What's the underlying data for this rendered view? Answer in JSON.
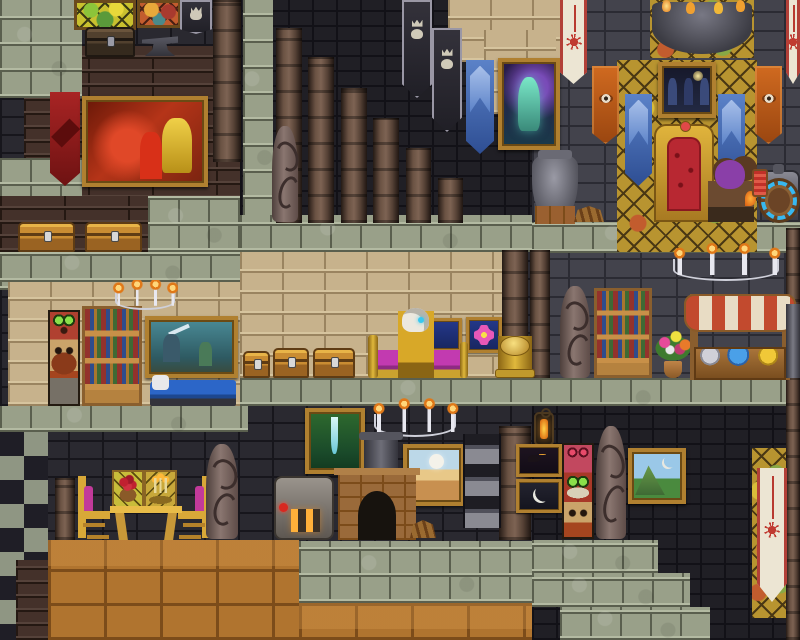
{
  "meta": {
    "scene_name": "castle-interior-game-scene",
    "scene_type": "2d-sandbox-side-view",
    "visible_text": []
  },
  "palette": {
    "stone_slab": "#99a089",
    "dark_brick": "#2a2930",
    "black_brick": "#201f25",
    "gray_brick": "#43434c",
    "sandstone_brick": "#c7b28c",
    "mud_brick": "#b0742f",
    "wood_plank": "#44312a",
    "gold_accent": "#c9982f",
    "stained_glass_gold": "#b89430",
    "banner_red": "#a82424",
    "banner_blue": "#4a6fb5",
    "banner_black": "#34323b",
    "banner_white": "#ece5d3",
    "banner_orange": "#d06a20",
    "throne_red": "#b82832",
    "bed_blue": "#2c66c8",
    "bed_purple_sheet": "#c23ab0",
    "awning_red": "#c24a2e",
    "flame_orange": "#f0a030",
    "gem_blue": "#4aa0e8"
  },
  "regions": [
    {
      "name": "wall-dark-brick-base",
      "tex": "darkbrick",
      "x": 0,
      "y": 0,
      "w": 800,
      "h": 640
    },
    {
      "name": "wall-black-brick-stairwell",
      "tex": "blackbrick",
      "x": 240,
      "y": 0,
      "w": 292,
      "h": 252
    },
    {
      "name": "wall-gray-brick-right",
      "tex": "graybrick",
      "x": 532,
      "y": 0,
      "w": 268,
      "h": 640
    },
    {
      "name": "wall-black-brick-bottom-right",
      "tex": "blackbrick",
      "x": 532,
      "y": 406,
      "w": 268,
      "h": 234
    },
    {
      "name": "wall-sandstone-top",
      "tex": "sandbrick",
      "x": 448,
      "y": 0,
      "w": 112,
      "h": 62
    },
    {
      "name": "wall-sandstone-top-2",
      "tex": "sandbrick",
      "x": 484,
      "y": 30,
      "w": 72,
      "h": 84
    },
    {
      "name": "wall-planks-top-left",
      "tex": "planks",
      "x": 24,
      "y": 46,
      "w": 216,
      "h": 167
    },
    {
      "name": "wall-slab-left-upper",
      "tex": "slab",
      "x": 0,
      "y": 0,
      "w": 82,
      "h": 98
    },
    {
      "name": "wall-slab-left-lower",
      "tex": "slab",
      "x": 0,
      "y": 158,
      "w": 82,
      "h": 132
    },
    {
      "name": "pillar-slab",
      "tex": "slab",
      "x": 243,
      "y": 0,
      "w": 30,
      "h": 225
    },
    {
      "name": "wall-planks-chest-ledge",
      "tex": "planks",
      "x": 0,
      "y": 196,
      "w": 148,
      "h": 56
    },
    {
      "name": "wall-slab-mid-left",
      "tex": "slab",
      "x": 148,
      "y": 196,
      "w": 92,
      "h": 56
    },
    {
      "name": "floor-slab-left-band",
      "tex": "slab",
      "x": 0,
      "y": 252,
      "w": 240,
      "h": 30
    },
    {
      "name": "wall-sandstone-left-room",
      "tex": "sandbrick",
      "x": 8,
      "y": 282,
      "w": 236,
      "h": 124
    },
    {
      "name": "ceiling-slab-center",
      "tex": "slab",
      "x": 240,
      "y": 215,
      "w": 292,
      "h": 37
    },
    {
      "name": "wall-sandstone-center-room",
      "tex": "sandbrick",
      "x": 240,
      "y": 252,
      "w": 264,
      "h": 126
    },
    {
      "name": "ceiling-slab-right",
      "tex": "slab",
      "x": 532,
      "y": 222,
      "w": 268,
      "h": 31
    },
    {
      "name": "floor-slab-left-room",
      "tex": "slab",
      "x": 0,
      "y": 406,
      "w": 248,
      "h": 26
    },
    {
      "name": "wall-checker-left",
      "tex": "checker",
      "x": 0,
      "y": 432,
      "w": 48,
      "h": 208
    },
    {
      "name": "floor-slab-main",
      "tex": "slab",
      "x": 240,
      "y": 378,
      "w": 560,
      "h": 28
    },
    {
      "name": "floor-mudbrick-left",
      "tex": "mudbrick",
      "x": 48,
      "y": 540,
      "w": 251,
      "h": 100
    },
    {
      "name": "floor-slab-bottom-center",
      "tex": "slab",
      "x": 299,
      "y": 541,
      "w": 233,
      "h": 62
    },
    {
      "name": "floor-mudbrick-center",
      "tex": "mudbrick",
      "x": 299,
      "y": 603,
      "w": 233,
      "h": 37
    },
    {
      "name": "stair-slab-1",
      "tex": "slab",
      "x": 532,
      "y": 540,
      "w": 126,
      "h": 33
    },
    {
      "name": "stair-slab-2",
      "tex": "slab",
      "x": 532,
      "y": 573,
      "w": 158,
      "h": 34
    },
    {
      "name": "stair-slab-3",
      "tex": "slab",
      "x": 560,
      "y": 607,
      "w": 150,
      "h": 33
    },
    {
      "name": "wall-planks-bottom-left",
      "tex": "planks",
      "x": 16,
      "y": 560,
      "w": 32,
      "h": 80
    },
    {
      "name": "window-stained-glass-throne-top",
      "tex": "glassgold",
      "x": 650,
      "y": 0,
      "w": 104,
      "h": 58
    },
    {
      "name": "window-stained-glass-throne",
      "tex": "glassgold",
      "x": 617,
      "y": 60,
      "w": 140,
      "h": 192
    },
    {
      "name": "window-stained-glass-bottom-right",
      "tex": "glassgold",
      "x": 752,
      "y": 448,
      "w": 40,
      "h": 170
    }
  ],
  "columns": [
    {
      "name": "wood-column",
      "x": 213,
      "y": 0,
      "w": 28,
      "h": 162
    },
    {
      "name": "wood-column-stair-1",
      "x": 276,
      "y": 28,
      "w": 26,
      "h": 195
    },
    {
      "name": "wood-column-stair-2",
      "x": 308,
      "y": 57,
      "w": 26,
      "h": 166
    },
    {
      "name": "wood-column-stair-3",
      "x": 341,
      "y": 88,
      "w": 26,
      "h": 135
    },
    {
      "name": "wood-column-stair-4",
      "x": 373,
      "y": 118,
      "w": 26,
      "h": 105
    },
    {
      "name": "wood-column-stair-5",
      "x": 406,
      "y": 148,
      "w": 25,
      "h": 75
    },
    {
      "name": "wood-column-stair-6",
      "x": 438,
      "y": 178,
      "w": 25,
      "h": 45
    },
    {
      "name": "wood-column-divider-1",
      "x": 502,
      "y": 250,
      "w": 26,
      "h": 128
    },
    {
      "name": "wood-column-divider-2",
      "x": 530,
      "y": 250,
      "w": 20,
      "h": 128
    },
    {
      "name": "wood-column-bottom",
      "x": 499,
      "y": 426,
      "w": 32,
      "h": 114
    },
    {
      "name": "wood-column-right-edge",
      "x": 786,
      "y": 228,
      "w": 14,
      "h": 412
    },
    {
      "name": "wood-column-dining",
      "x": 55,
      "y": 478,
      "w": 20,
      "h": 62
    }
  ],
  "objects": [
    {
      "name": "stained-glass-window-yellow-green",
      "type": "window",
      "mod": "tex-glassyg",
      "x": 74,
      "y": 0,
      "w": 62,
      "h": 30,
      "int": false
    },
    {
      "name": "stained-glass-window-orange",
      "type": "window",
      "mod": "tex-glassor",
      "x": 137,
      "y": 0,
      "w": 44,
      "h": 28,
      "int": false
    },
    {
      "name": "black-banner-small",
      "type": "banner-skull",
      "mod": "banner",
      "x": 180,
      "y": 0,
      "w": 32,
      "h": 34,
      "int": false
    },
    {
      "name": "shadow-chest",
      "type": "chest-shadow",
      "x": 85,
      "y": 27,
      "w": 50,
      "h": 30,
      "int": true
    },
    {
      "name": "iron-anvil",
      "type": "anvil",
      "x": 142,
      "y": 36,
      "w": 36,
      "h": 20,
      "int": true
    },
    {
      "name": "red-banner",
      "type": "banner-red",
      "mod": "banner",
      "x": 50,
      "y": 92,
      "w": 30,
      "h": 94,
      "int": false
    },
    {
      "name": "painting-knight-vs-worm",
      "type": "painting",
      "mod": "d-knight",
      "grad": "radial-gradient(circle at 35% 55%,#e04828 0 18%,transparent 40%),linear-gradient(135deg,#6a1808,#b53418 45%,#7a2410)",
      "x": 82,
      "y": 96,
      "w": 126,
      "h": 91,
      "int": false
    },
    {
      "name": "gold-chest",
      "type": "chest",
      "x": 18,
      "y": 222,
      "w": 57,
      "h": 30,
      "int": true
    },
    {
      "name": "gold-chest",
      "type": "chest",
      "x": 85,
      "y": 222,
      "w": 57,
      "h": 30,
      "int": true
    },
    {
      "name": "gargoyle-statue",
      "type": "gargoyle",
      "x": 272,
      "y": 126,
      "w": 26,
      "h": 96,
      "int": false
    },
    {
      "name": "skull-banner",
      "type": "banner-skull",
      "mod": "banner",
      "x": 402,
      "y": 0,
      "w": 30,
      "h": 98,
      "int": false
    },
    {
      "name": "skull-banner",
      "type": "banner-skull",
      "mod": "banner",
      "x": 432,
      "y": 28,
      "w": 30,
      "h": 104,
      "int": false
    },
    {
      "name": "blue-banner",
      "type": "banner-blue",
      "mod": "banner",
      "x": 466,
      "y": 60,
      "w": 28,
      "h": 94,
      "int": false
    },
    {
      "name": "painting-necromancer",
      "type": "painting",
      "mod": "d-ghost",
      "grad": "radial-gradient(circle at 60% 30%,#7a4ab8 0 20%,transparent 50%),linear-gradient(#2a1a4a,#1a3a4a)",
      "x": 498,
      "y": 58,
      "w": 62,
      "h": 92,
      "int": false
    },
    {
      "name": "white-sun-banner",
      "type": "banner-white",
      "mod": "banner",
      "x": 560,
      "y": 0,
      "w": 27,
      "h": 84,
      "int": false
    },
    {
      "name": "white-sun-banner-cut",
      "type": "banner-white",
      "mod": "banner",
      "x": 786,
      "y": 0,
      "w": 14,
      "h": 84,
      "int": false
    },
    {
      "name": "orange-eye-banner",
      "type": "banner-orange",
      "mod": "banner",
      "x": 592,
      "y": 66,
      "w": 27,
      "h": 78,
      "int": false
    },
    {
      "name": "orange-eye-banner",
      "type": "banner-orange",
      "mod": "banner",
      "x": 755,
      "y": 66,
      "w": 27,
      "h": 78,
      "int": false
    },
    {
      "name": "blue-banner",
      "type": "banner-blue",
      "mod": "banner",
      "x": 625,
      "y": 94,
      "w": 27,
      "h": 92,
      "int": false
    },
    {
      "name": "blue-banner",
      "type": "banner-blue",
      "mod": "banner",
      "x": 718,
      "y": 94,
      "w": 27,
      "h": 92,
      "int": false
    },
    {
      "name": "painting-warrior-band",
      "type": "painting",
      "mod": "d-band",
      "grad": "linear-gradient(#16182a,#232a44)",
      "x": 658,
      "y": 62,
      "w": 58,
      "h": 56,
      "int": false
    },
    {
      "name": "iron-chandelier",
      "type": "chandelier-iron",
      "x": 652,
      "y": 2,
      "w": 100,
      "h": 52,
      "int": false
    },
    {
      "name": "royal-throne",
      "type": "throne",
      "x": 654,
      "y": 124,
      "w": 60,
      "h": 98,
      "int": true
    },
    {
      "name": "cauldron-furnace",
      "type": "cauldron",
      "x": 532,
      "y": 154,
      "w": 46,
      "h": 68,
      "int": true
    },
    {
      "name": "folded-fan",
      "type": "fan",
      "x": 574,
      "y": 206,
      "w": 30,
      "h": 16,
      "int": false
    },
    {
      "name": "hellforge",
      "type": "forge",
      "x": 760,
      "y": 170,
      "w": 40,
      "h": 52,
      "int": true
    },
    {
      "name": "npc-antler-villager",
      "type": "npc",
      "x": 708,
      "y": 160,
      "w": 46,
      "h": 62,
      "int": true
    },
    {
      "name": "sharpening-station",
      "type": "sharpen",
      "x": 750,
      "y": 172,
      "w": 50,
      "h": 50,
      "int": true
    },
    {
      "name": "tiki-totem",
      "type": "tiki",
      "mod": "tiki-a",
      "x": 48,
      "y": 310,
      "w": 32,
      "h": 96,
      "int": false
    },
    {
      "name": "wooden-bookshelf",
      "type": "bookshelf",
      "x": 82,
      "y": 306,
      "w": 60,
      "h": 100,
      "int": false
    },
    {
      "name": "silver-chandelier",
      "type": "chandelier-silver",
      "x": 112,
      "y": 280,
      "w": 66,
      "h": 36,
      "int": false
    },
    {
      "name": "painting-undersea-battle",
      "type": "painting",
      "mod": "d-fight",
      "grad": "linear-gradient(#4a8a96,#2e5a62 70%,#3a4a3a)",
      "x": 145,
      "y": 316,
      "w": 93,
      "h": 62,
      "int": false
    },
    {
      "name": "blue-bed",
      "type": "bed-blue",
      "x": 150,
      "y": 380,
      "w": 86,
      "h": 26,
      "int": true
    },
    {
      "name": "gold-chest-small",
      "type": "chest",
      "x": 243,
      "y": 351,
      "w": 27,
      "h": 27,
      "int": true
    },
    {
      "name": "gold-chest",
      "type": "chest",
      "x": 273,
      "y": 348,
      "w": 36,
      "h": 30,
      "int": true
    },
    {
      "name": "gold-chest",
      "type": "chest",
      "x": 313,
      "y": 348,
      "w": 42,
      "h": 30,
      "int": true
    },
    {
      "name": "painting-small-blue",
      "type": "painting-sm",
      "grad": "linear-gradient(#24388a,#182660)",
      "x": 426,
      "y": 318,
      "w": 36,
      "h": 34,
      "int": false
    },
    {
      "name": "painting-pink-flower",
      "type": "painting-sm",
      "mod": "d-flower",
      "grad": "linear-gradient(#24388a,#182660)",
      "x": 466,
      "y": 317,
      "w": 36,
      "h": 36,
      "int": false
    },
    {
      "name": "golden-bed-purple",
      "type": "bed-gold",
      "x": 372,
      "y": 350,
      "w": 94,
      "h": 28,
      "int": true
    },
    {
      "name": "gold-lamp",
      "type": "lampgold",
      "x": 498,
      "y": 336,
      "w": 34,
      "h": 42,
      "int": false
    },
    {
      "name": "player-gold-armor",
      "type": "player",
      "x": 398,
      "y": 308,
      "w": 36,
      "h": 70,
      "int": false
    },
    {
      "name": "gargoyle-statue",
      "type": "gargoyle",
      "x": 560,
      "y": 286,
      "w": 30,
      "h": 92,
      "int": false
    },
    {
      "name": "wooden-bookshelf",
      "type": "bookshelf",
      "x": 594,
      "y": 288,
      "w": 58,
      "h": 90,
      "int": false
    },
    {
      "name": "flower-bouquet-pot",
      "type": "flowers",
      "x": 654,
      "y": 330,
      "w": 38,
      "h": 48,
      "int": false
    },
    {
      "name": "silver-chandelier",
      "type": "chandelier-silver",
      "x": 668,
      "y": 243,
      "w": 116,
      "h": 46,
      "int": false
    },
    {
      "name": "market-stall-gems",
      "type": "stall",
      "x": 690,
      "y": 294,
      "w": 100,
      "h": 86,
      "int": true
    },
    {
      "name": "pipe-machine",
      "type": "pipe",
      "x": 786,
      "y": 304,
      "w": 14,
      "h": 74,
      "int": false
    },
    {
      "name": "stained-glass-panel-roses",
      "type": "sgpanel",
      "mod": "sg-roses",
      "x": 112,
      "y": 470,
      "w": 32,
      "h": 38,
      "int": false
    },
    {
      "name": "stained-glass-panel-candelabra",
      "type": "sgpanel",
      "mod": "sg-candle",
      "x": 144,
      "y": 470,
      "w": 33,
      "h": 38,
      "int": false
    },
    {
      "name": "golden-chair",
      "type": "chair",
      "mod": "flip",
      "x": 78,
      "y": 476,
      "w": 32,
      "h": 62,
      "int": true
    },
    {
      "name": "golden-chair",
      "type": "chair",
      "x": 178,
      "y": 476,
      "w": 32,
      "h": 62,
      "int": true
    },
    {
      "name": "golden-table",
      "type": "table",
      "x": 110,
      "y": 506,
      "w": 72,
      "h": 34,
      "int": false
    },
    {
      "name": "gargoyle-statue",
      "type": "gargoyle",
      "x": 206,
      "y": 444,
      "w": 32,
      "h": 95,
      "int": false
    },
    {
      "name": "painting-jungle-waterfall",
      "type": "painting",
      "mod": "d-waterfall",
      "grad": "linear-gradient(#2e6a2e,#1a4a2a 70%,#123a20)",
      "x": 305,
      "y": 408,
      "w": 60,
      "h": 66,
      "int": false
    },
    {
      "name": "silver-chandelier",
      "type": "chandelier-silver",
      "x": 370,
      "y": 398,
      "w": 90,
      "h": 48,
      "int": false
    },
    {
      "name": "painting-desert-moon",
      "type": "painting",
      "mod": "d-fullmoon",
      "grad": "linear-gradient(#bcd8e8 0 40%,#e8c888 40% 60%,#c89050 60%)",
      "x": 403,
      "y": 444,
      "w": 62,
      "h": 62,
      "int": false
    },
    {
      "name": "steam-boiler",
      "type": "boiler",
      "x": 274,
      "y": 476,
      "w": 60,
      "h": 64,
      "int": true
    },
    {
      "name": "furnace-chimney",
      "type": "chimney",
      "x": 364,
      "y": 432,
      "w": 34,
      "h": 42,
      "int": false
    },
    {
      "name": "brick-fireplace",
      "type": "fireplace",
      "x": 338,
      "y": 468,
      "w": 78,
      "h": 72,
      "int": true
    },
    {
      "name": "folded-fan",
      "type": "fan",
      "x": 410,
      "y": 520,
      "w": 26,
      "h": 18,
      "int": false
    },
    {
      "name": "metal-shelf-blocks",
      "type": "metalshelf",
      "x": 463,
      "y": 434,
      "w": 38,
      "h": 94,
      "int": false
    },
    {
      "name": "hanging-lantern",
      "type": "lantern",
      "x": 534,
      "y": 412,
      "w": 20,
      "h": 34,
      "int": false
    },
    {
      "name": "painting-dark-bird",
      "type": "painting-sm",
      "mod": "d-bird",
      "grad": "linear-gradient(#1e1420,#120c16)",
      "x": 516,
      "y": 444,
      "w": 46,
      "h": 33,
      "int": false
    },
    {
      "name": "painting-crescent-moon",
      "type": "painting-sm",
      "mod": "d-crescent",
      "grad": "linear-gradient(#242430,#14141e)",
      "x": 516,
      "y": 479,
      "w": 46,
      "h": 34,
      "int": false
    },
    {
      "name": "tiki-totem",
      "type": "tiki",
      "mod": "tiki-b",
      "x": 562,
      "y": 443,
      "w": 32,
      "h": 96,
      "int": false
    },
    {
      "name": "gargoyle-statue",
      "type": "gargoyle",
      "x": 596,
      "y": 426,
      "w": 30,
      "h": 113,
      "int": false
    },
    {
      "name": "painting-mountain-lake",
      "type": "painting",
      "mod": "d-mountain",
      "grad": "linear-gradient(#9ac8e8 0 55%,#4a8a3e 55%)",
      "x": 628,
      "y": 448,
      "w": 58,
      "h": 56,
      "int": false
    },
    {
      "name": "white-sun-banner",
      "type": "banner-white",
      "mod": "banner",
      "x": 757,
      "y": 468,
      "w": 30,
      "h": 134,
      "int": false
    }
  ]
}
